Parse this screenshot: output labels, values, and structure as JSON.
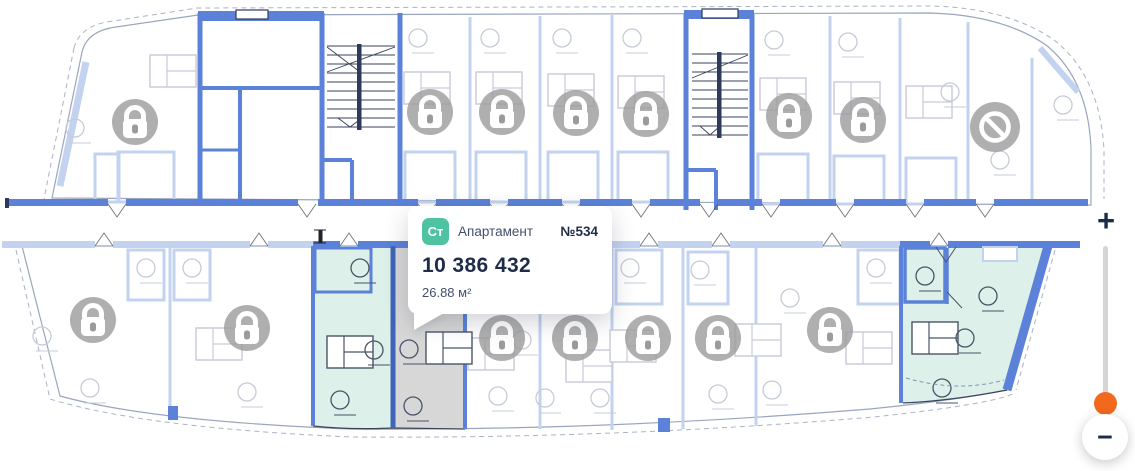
{
  "plan": {
    "tooltip": {
      "badge": "Ст",
      "type_label": "Апартамент",
      "number": "№534",
      "price": "10 386 432",
      "area": "26.88 м²"
    },
    "zoom_control": {
      "zoom_in_label": "+",
      "zoom_out_label": "−"
    }
  },
  "icons": {
    "lock": "lock-icon",
    "prohibited": "prohibited-icon",
    "zoom_in": "plus-icon",
    "zoom_out": "minus-icon"
  },
  "colors": {
    "wall_bright": "#5b82d8",
    "wall_faded": "#c3d2ef",
    "wall_dark": "#2e3a5c",
    "wall_navy": "#3f64b8",
    "outline": "#9aa5bf",
    "detail_faded": "#c6cbd9",
    "detail_dark": "#4a5568",
    "available_fill": "#ddf0e9",
    "selected_fill": "#d7d7d7",
    "lock_gray": "#9b9b9b",
    "badge_green": "#4fc3a1",
    "text_dark": "#1f2c49",
    "text_muted": "#44506a",
    "slider_handle_orange": "#f2691e",
    "slider_track": "#d5d5d6"
  }
}
